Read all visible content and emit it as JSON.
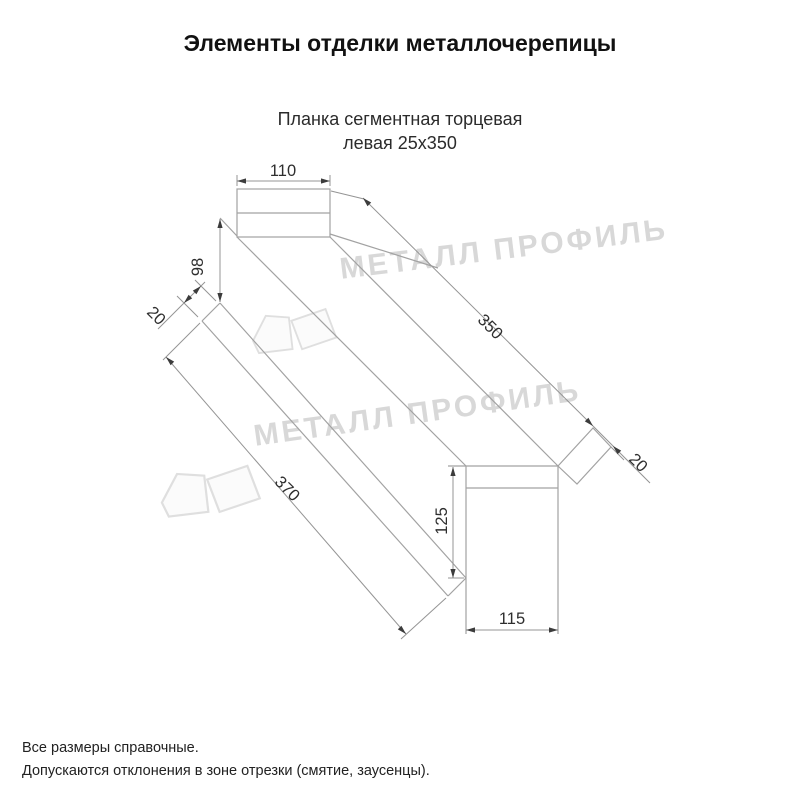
{
  "header": {
    "title": "Элементы отделки металлочерепицы"
  },
  "product": {
    "name_line1": "Планка сегментная торцевая",
    "name_line2": "левая 25х350"
  },
  "drawing": {
    "dims": {
      "flange_width": "110",
      "back_height": "98",
      "back_lip": "20",
      "length_top": "350",
      "length_front": "370",
      "end_lip": "20",
      "face_height": "125",
      "face_width": "115"
    },
    "line_color": "#a2a2a2",
    "dim_text_color": "#2e2e2e"
  },
  "watermark": {
    "text": "МЕТАЛЛ ПРОФИЛЬ",
    "color": "#d8d8d8"
  },
  "footer": {
    "line1": "Все размеры справочные.",
    "line2": "Допускаются отклонения в зоне отрезки (смятие, заусенцы)."
  }
}
